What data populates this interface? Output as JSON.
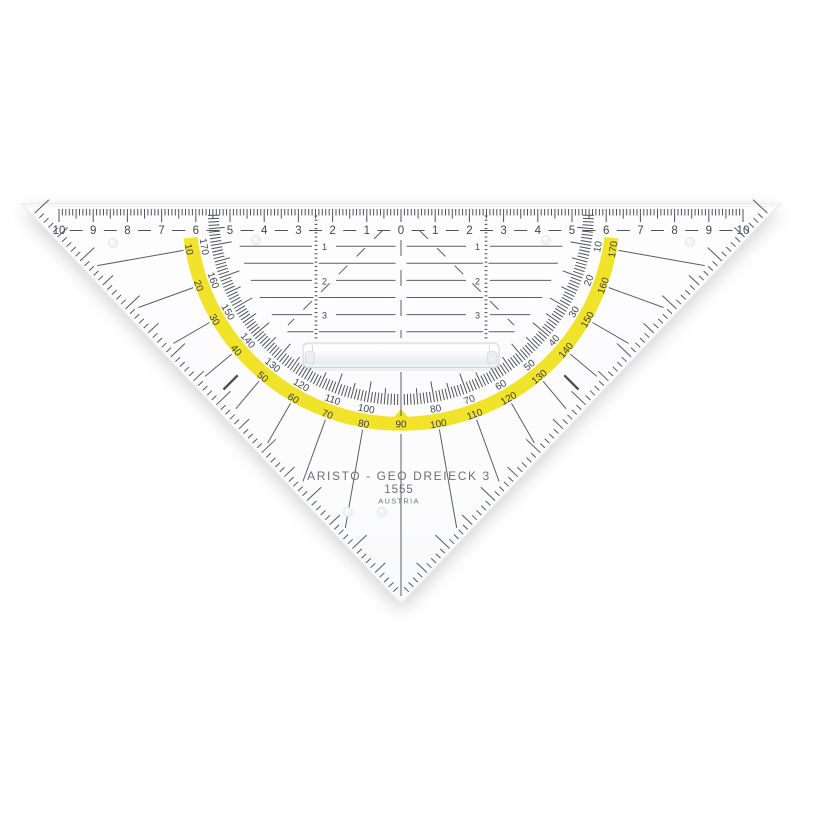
{
  "colors": {
    "ink": "#434649",
    "line": "#5a5e60",
    "arc_yellow": "#f0e32a",
    "body": "#fdfdfe",
    "brand_gray": "#6e7072",
    "handle_edge": "#cfd3d6"
  },
  "branding": {
    "line1": "ARISTO - GEO DREIECK 3",
    "line2": "1555",
    "line3": "AUSTRIA"
  },
  "ruler_scale": {
    "numbers": [
      10,
      9,
      8,
      7,
      6,
      5,
      4,
      3,
      2,
      1,
      0,
      1,
      2,
      3,
      4,
      5,
      6,
      7,
      8,
      9,
      10
    ]
  },
  "protractor": {
    "outer_scale_degrees": [
      10,
      20,
      30,
      40,
      50,
      60,
      70,
      80,
      90,
      100,
      110,
      120,
      130,
      140,
      150,
      160,
      170
    ],
    "inner_scale_degrees": [
      170,
      160,
      150,
      140,
      130,
      120,
      110,
      100,
      80,
      70,
      60,
      50,
      40,
      30,
      20,
      10
    ]
  },
  "parallel_guides": {
    "left_numbers": [
      1,
      2,
      3
    ],
    "right_numbers": [
      1,
      2,
      3
    ]
  }
}
